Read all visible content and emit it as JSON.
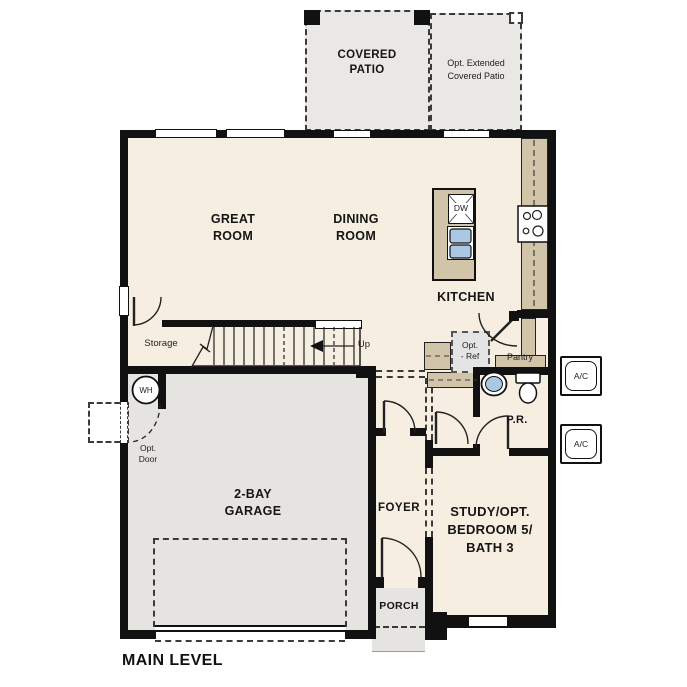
{
  "plan": {
    "title": "MAIN LEVEL",
    "rooms": {
      "great_room": {
        "l1": "GREAT",
        "l2": "ROOM"
      },
      "dining_room": {
        "l1": "DINING",
        "l2": "ROOM"
      },
      "kitchen": "KITCHEN",
      "garage": {
        "l1": "2-BAY",
        "l2": "GARAGE"
      },
      "foyer": "FOYER",
      "study": {
        "l1": "STUDY/OPT.",
        "l2": "BEDROOM 5/",
        "l3": "BATH 3"
      },
      "porch": "PORCH",
      "powder_room": "P.R.",
      "pantry": "Pantry",
      "storage": "Storage",
      "covered_patio": {
        "l1": "COVERED",
        "l2": "PATIO"
      },
      "extended_patio": {
        "l1": "Opt. Extended",
        "l2": "Covered Patio"
      }
    },
    "annotations": {
      "up": "Up",
      "water_heater": "WH",
      "dishwasher": "DW",
      "ac": "A/C",
      "opt_ref": {
        "l1": "Opt.",
        "l2": "- Ref"
      },
      "opt_door": {
        "l1": "Opt.",
        "l2": "Door"
      }
    },
    "colors": {
      "floor": "#f6eee0",
      "garage_floor": "#e5e4e1",
      "patio_floor": "#eae8e5",
      "counter": "#d1c4a9",
      "fixture_blue": "#aac7e4",
      "wall": "#111111"
    }
  }
}
